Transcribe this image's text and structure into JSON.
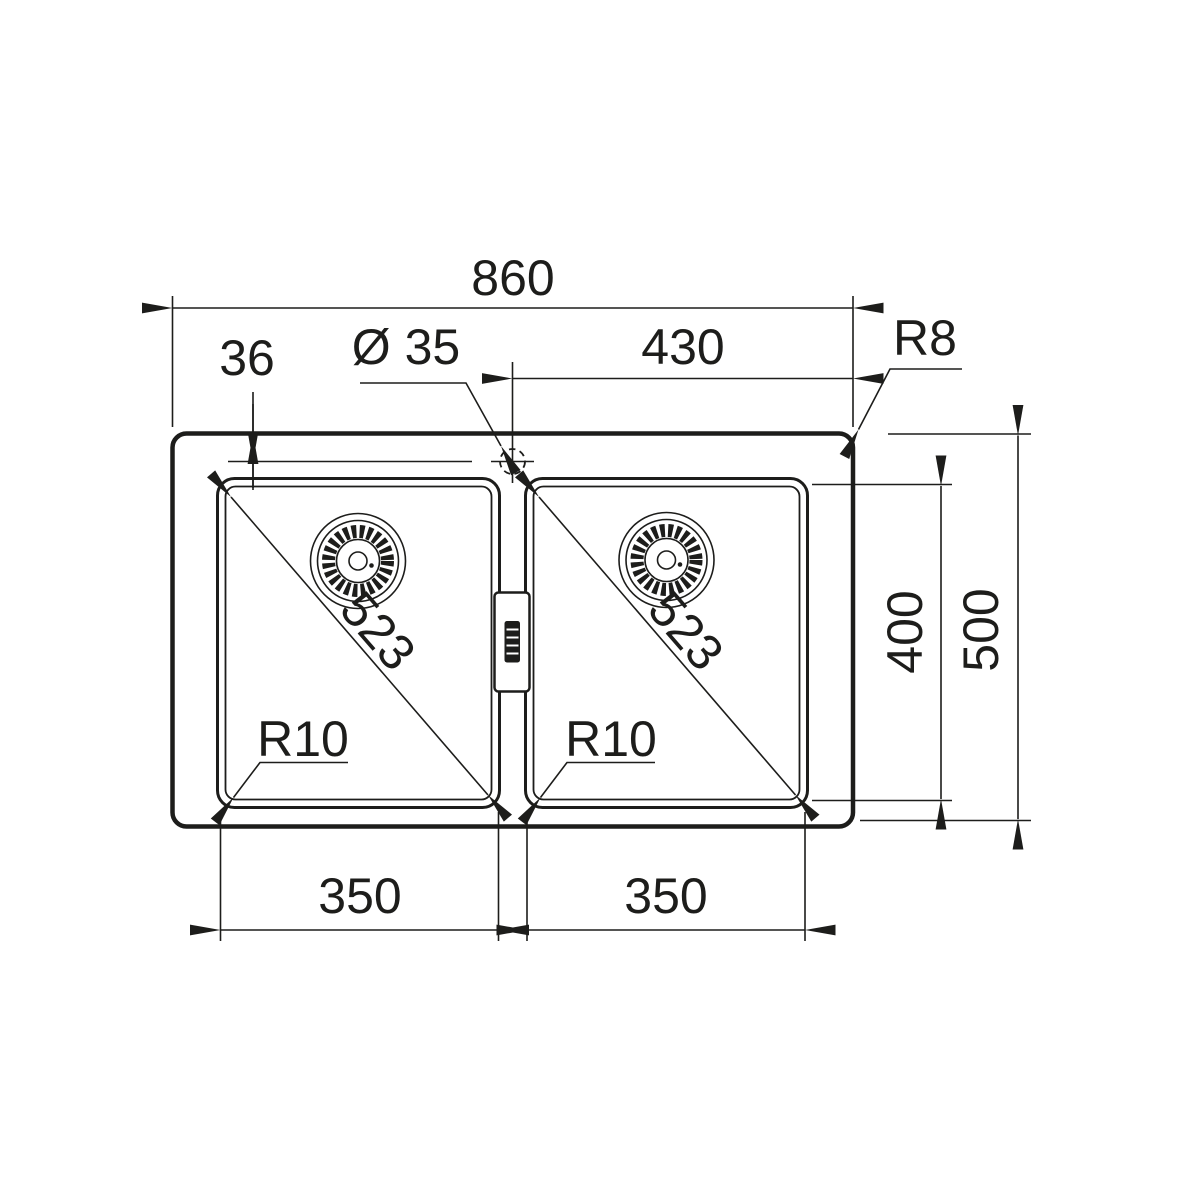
{
  "colors": {
    "ink": "#1d1d1b",
    "background": "#ffffff"
  },
  "drawing_title": "double-bowl-sink-dimension-drawing",
  "labels": {
    "overall_width": "860",
    "half_width": "430",
    "rim_corner_radius": "R8",
    "faucet_offset": "36",
    "faucet_hole_diameter": "Ø 35",
    "bowl_depth": "400",
    "overall_depth": "500",
    "left_bowl": {
      "diagonal": "523",
      "corner_radius": "R10",
      "width": "350"
    },
    "right_bowl": {
      "diagonal": "523",
      "corner_radius": "R10",
      "width": "350"
    }
  }
}
